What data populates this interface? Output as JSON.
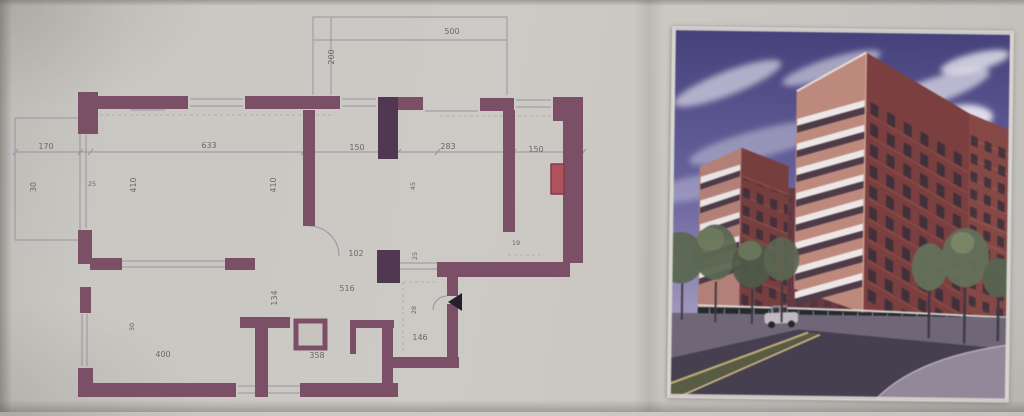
{
  "colors": {
    "paper": "#c9c7c2",
    "wall": "#7b4e66",
    "wall_shaft_dark": "#4e3550",
    "thin_line": "#9d92a0",
    "dim_text": "#6f6468",
    "balcony_door_red": "#b2505c",
    "sky_top": "#46417f",
    "sky_horizon": "#b7aec7",
    "brick_lit": "#c1887a",
    "brick_shadow": "#7e3e3d",
    "balcony_slab_white": "#ece6e6",
    "storefront_glass": "#23292d",
    "road": "#453f50",
    "lane_marking": "#c4b275",
    "tree_green": "#5a6751"
  },
  "plan": {
    "dims": [
      {
        "v": "500",
        "x": 452,
        "y": 34,
        "rot": 0
      },
      {
        "v": "200",
        "x": 334,
        "y": 57,
        "rot": -90
      },
      {
        "v": "170",
        "x": 46,
        "y": 149,
        "rot": 0
      },
      {
        "v": "633",
        "x": 209,
        "y": 148,
        "rot": 0
      },
      {
        "v": "150",
        "x": 357,
        "y": 150,
        "rot": 0
      },
      {
        "v": "283",
        "x": 448,
        "y": 149,
        "rot": 0
      },
      {
        "v": "150",
        "x": 536,
        "y": 152,
        "rot": 0
      },
      {
        "v": "30",
        "x": 36,
        "y": 187,
        "rot": -90
      },
      {
        "v": "25",
        "x": 92,
        "y": 186,
        "rot": 0
      },
      {
        "v": "410",
        "x": 136,
        "y": 185,
        "rot": -90
      },
      {
        "v": "410",
        "x": 276,
        "y": 185,
        "rot": -90
      },
      {
        "v": "45",
        "x": 415,
        "y": 186,
        "rot": -90
      },
      {
        "v": "102",
        "x": 356,
        "y": 256,
        "rot": 0
      },
      {
        "v": "25",
        "x": 417,
        "y": 256,
        "rot": -90
      },
      {
        "v": "19",
        "x": 516,
        "y": 245,
        "rot": 0
      },
      {
        "v": "516",
        "x": 347,
        "y": 291,
        "rot": 0
      },
      {
        "v": "134",
        "x": 277,
        "y": 298,
        "rot": -90
      },
      {
        "v": "28",
        "x": 416,
        "y": 310,
        "rot": -90
      },
      {
        "v": "146",
        "x": 420,
        "y": 340,
        "rot": 0
      },
      {
        "v": "30",
        "x": 134,
        "y": 327,
        "rot": -90
      },
      {
        "v": "400",
        "x": 163,
        "y": 357,
        "rot": 0
      },
      {
        "v": "358",
        "x": 317,
        "y": 358,
        "rot": 0
      }
    ]
  }
}
